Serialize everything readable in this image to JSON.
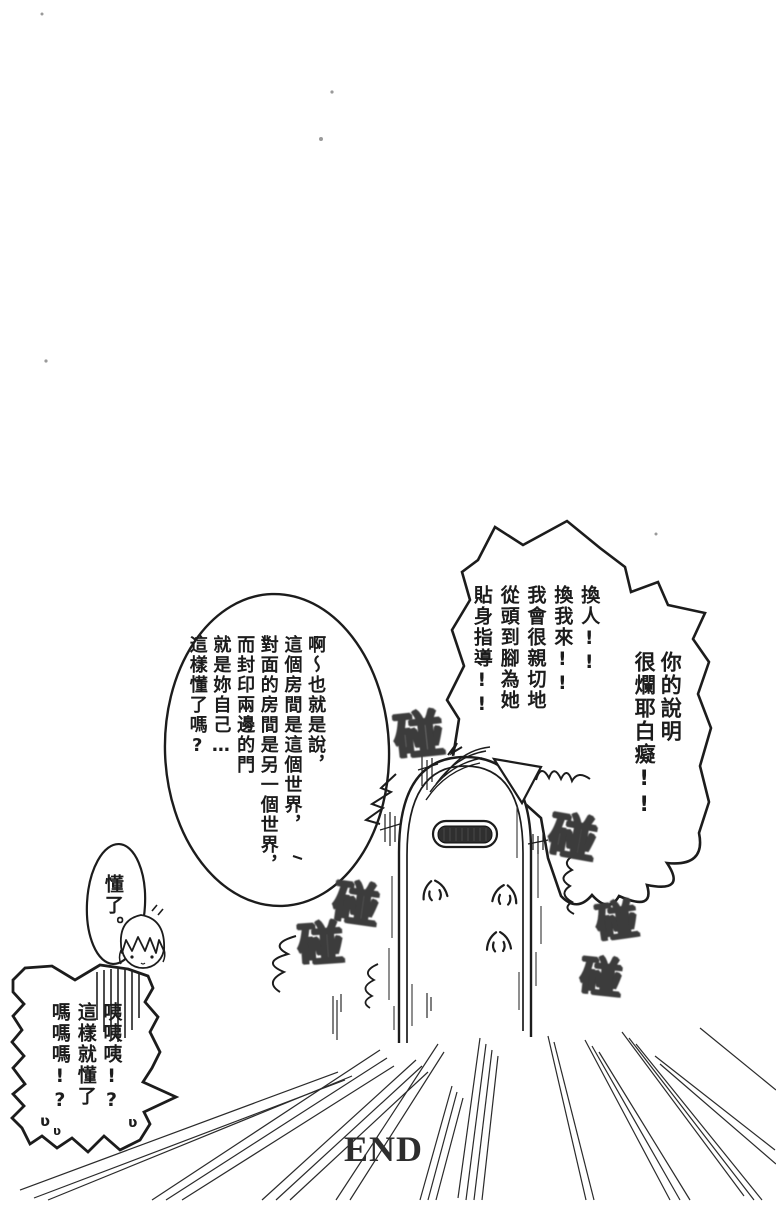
{
  "page": {
    "end_label": "END"
  },
  "bubbles": {
    "angry_shout": {
      "columns": [
        "你的說明",
        "很爛耶白癡!!",
        "換人!!",
        "換我來!!",
        "我會很親切地",
        "從頭到腳為她",
        "貼身指導!!"
      ]
    },
    "explanation": {
      "columns": [
        "啊〜也就是說，",
        "這個房間是這個世界，",
        "對面的房間是另一個世界，",
        "而封印兩邊的門",
        "就是妳自己…",
        "這樣懂了嗎?"
      ]
    },
    "reply": {
      "text": "懂了。"
    },
    "shock": {
      "columns": [
        "咦咦咦!?",
        "這樣就懂了",
        "嗎嗎嗎!?"
      ],
      "tremble_marks": [
        "ʋ",
        "ʋ",
        "ʋ"
      ]
    }
  },
  "sfx": {
    "bangs": [
      "碰",
      "碰",
      "碰",
      "碰",
      "碰",
      "碰"
    ]
  },
  "colors": {
    "ink": "#1c1c1c",
    "paper": "#ffffff",
    "sfx_ink": "#3c3c3c"
  }
}
